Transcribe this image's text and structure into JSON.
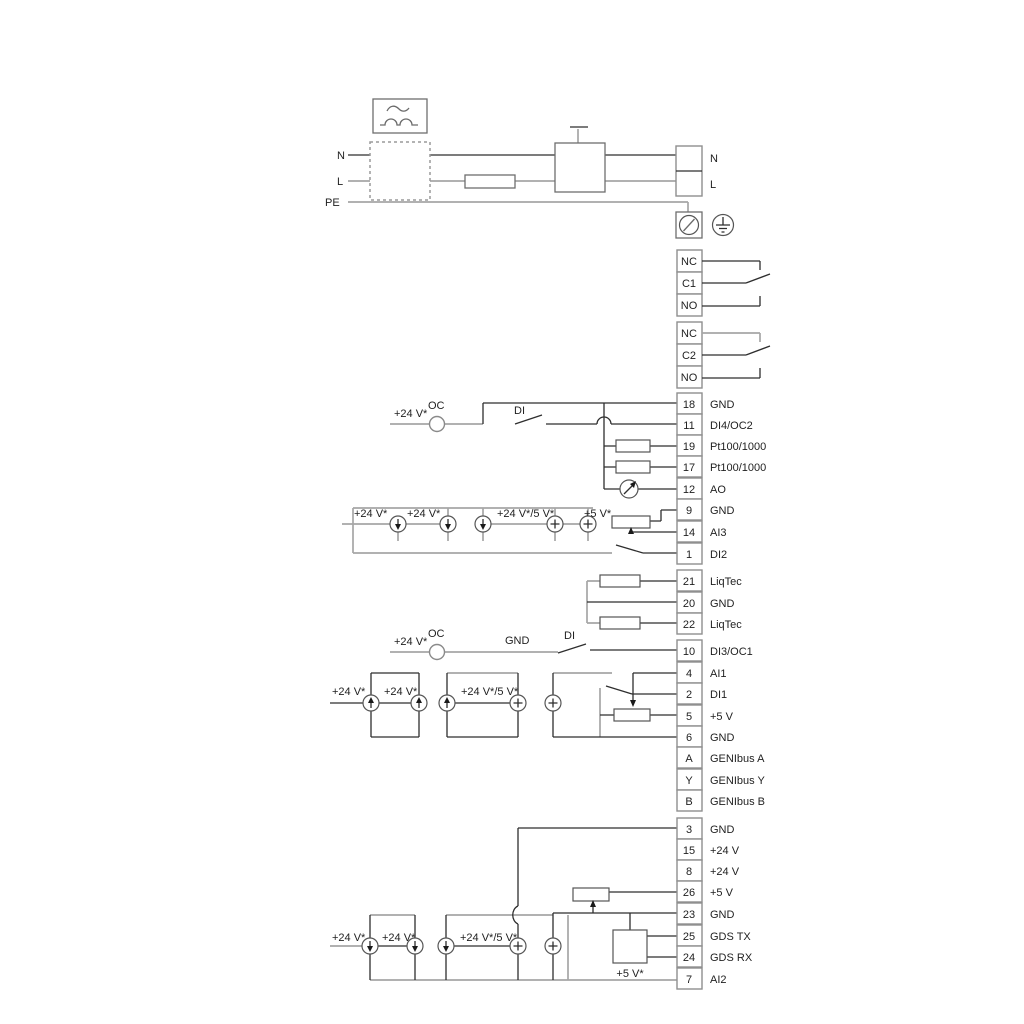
{
  "power": {
    "n_left": "N",
    "l_left": "L",
    "pe": "PE",
    "n_right": "N",
    "l_right": "L"
  },
  "relay1": {
    "nc": "NC",
    "c": "C1",
    "no": "NO"
  },
  "relay2": {
    "nc": "NC",
    "c": "C2",
    "no": "NO"
  },
  "terminals": [
    {
      "id": "18",
      "label": "GND"
    },
    {
      "id": "11",
      "label": "DI4/OC2"
    },
    {
      "id": "19",
      "label": "Pt100/1000"
    },
    {
      "id": "17",
      "label": "Pt100/1000"
    },
    {
      "id": "12",
      "label": "AO"
    },
    {
      "id": "9",
      "label": "GND"
    },
    {
      "id": "14",
      "label": "AI3"
    },
    {
      "id": "1",
      "label": "DI2"
    },
    {
      "id": "21",
      "label": "LiqTec"
    },
    {
      "id": "20",
      "label": "GND"
    },
    {
      "id": "22",
      "label": "LiqTec"
    },
    {
      "id": "10",
      "label": "DI3/OC1"
    },
    {
      "id": "4",
      "label": "AI1"
    },
    {
      "id": "2",
      "label": "DI1"
    },
    {
      "id": "5",
      "label": "+5 V"
    },
    {
      "id": "6",
      "label": "GND"
    },
    {
      "id": "A",
      "label": "GENIbus A"
    },
    {
      "id": "Y",
      "label": "GENIbus Y"
    },
    {
      "id": "B",
      "label": "GENIbus B"
    },
    {
      "id": "3",
      "label": "GND"
    },
    {
      "id": "15",
      "label": "+24 V"
    },
    {
      "id": "8",
      "label": "+24 V"
    },
    {
      "id": "26",
      "label": "+5 V"
    },
    {
      "id": "23",
      "label": "GND"
    },
    {
      "id": "25",
      "label": "GDS TX"
    },
    {
      "id": "24",
      "label": "GDS RX"
    },
    {
      "id": "7",
      "label": "AI2"
    }
  ],
  "ann": {
    "oc1_v24": "+24 V*",
    "oc1_oc": "OC",
    "oc1_di": "DI",
    "ai3_v24a": "+24 V*",
    "ai3_v24b": "+24 V*",
    "ai3_v24_5": "+24 V*/5 V*",
    "ai3_v5": "+5 V*",
    "oc2_v24": "+24 V*",
    "oc2_oc": "OC",
    "oc2_gnd": "GND",
    "oc2_di": "DI",
    "ai1_v24a": "+24 V*",
    "ai1_v24b": "+24 V*",
    "ai1_v24_5": "+24 V*/5 V*",
    "ai2_v24a": "+24 V*",
    "ai2_v24b": "+24 V*",
    "ai2_v24_5": "+24 V*/5 V*",
    "ai2_v5": "+5 V*"
  },
  "colors": {
    "wire_black": "#2e2e2e",
    "wire_gray": "#a6a6a6",
    "component_stroke": "#6e6e6e",
    "terminal_border": "#8f8f8f",
    "text": "#1f1f1f",
    "background": "#ffffff"
  }
}
